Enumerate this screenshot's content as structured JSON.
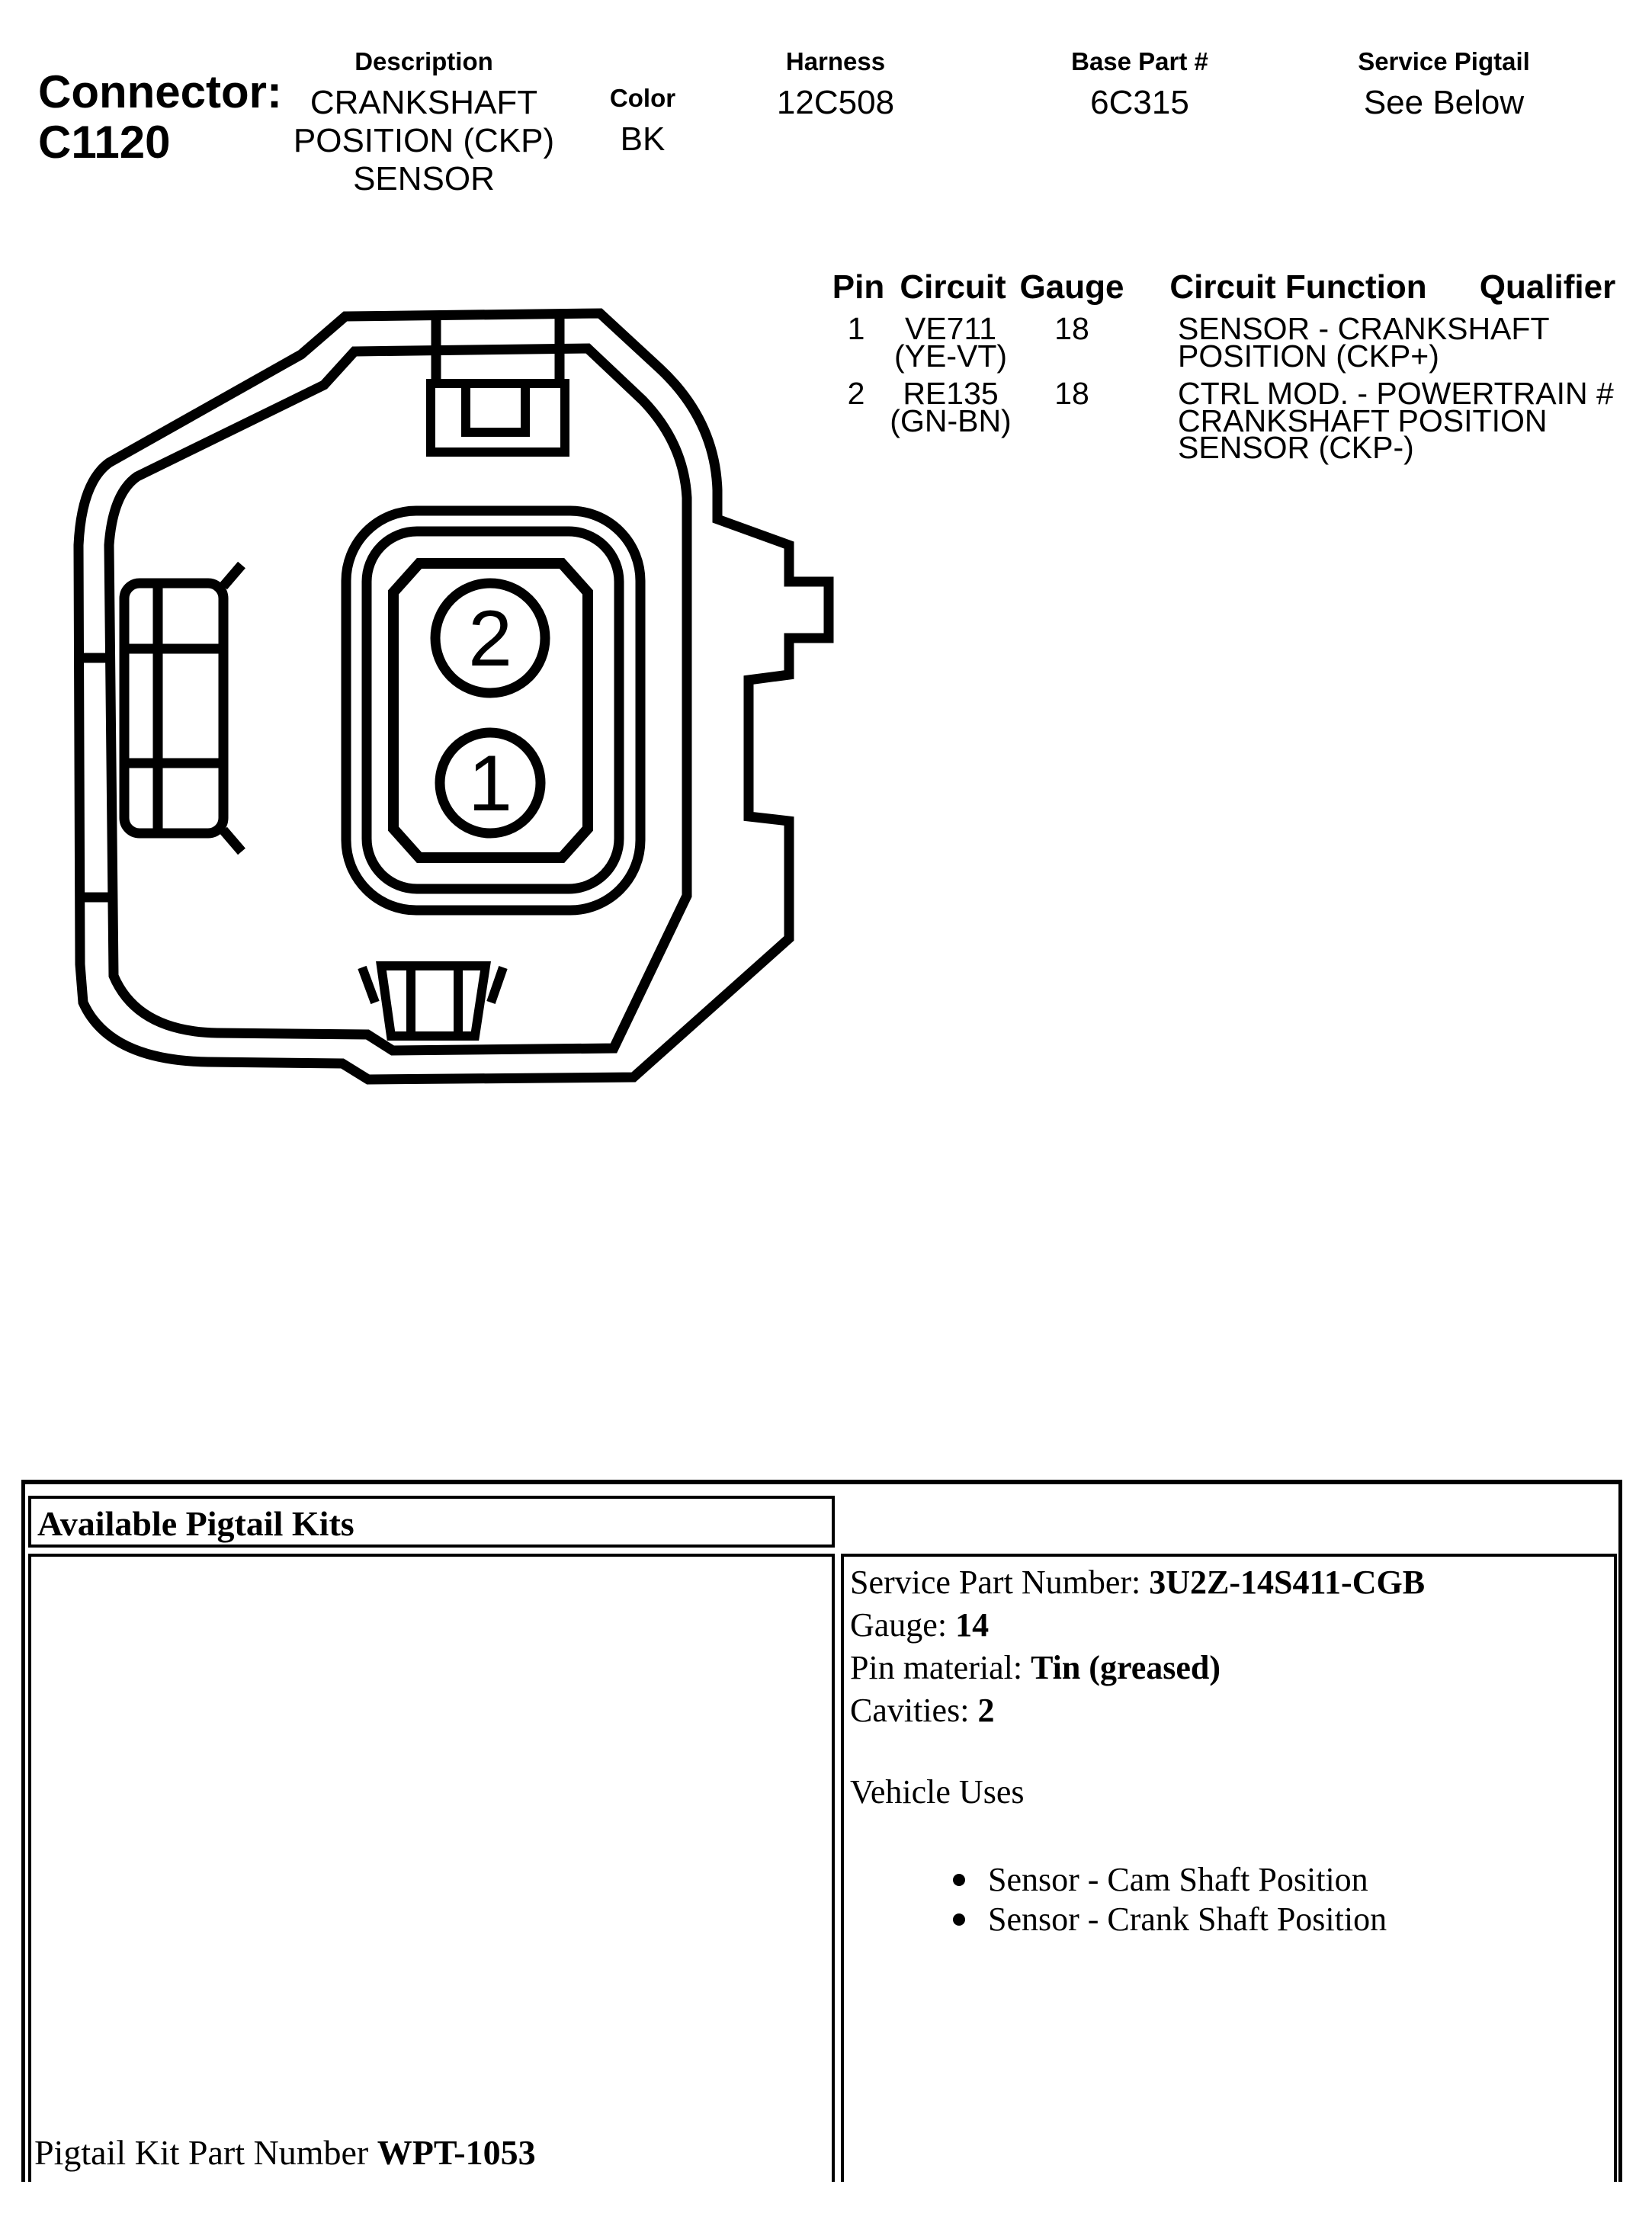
{
  "header": {
    "connector_label": "Connector:",
    "connector_id": "C1120",
    "description_label": "Description",
    "description_value": "CRANKSHAFT POSITION (CKP) SENSOR",
    "color_label": "Color",
    "color_value": "BK",
    "harness_label": "Harness",
    "harness_value": "12C508",
    "base_part_label": "Base Part #",
    "base_part_value": "6C315",
    "service_pigtail_label": "Service Pigtail",
    "service_pigtail_value": "See Below"
  },
  "pin_table": {
    "headers": {
      "pin": "Pin",
      "circuit": "Circuit",
      "gauge": "Gauge",
      "function": "Circuit Function",
      "qualifier": "Qualifier"
    },
    "rows": [
      {
        "pin": "1",
        "circuit": "VE711",
        "circuit_color": "(YE-VT)",
        "gauge": "18",
        "function_lines": [
          "SENSOR - CRANKSHAFT",
          "POSITION (CKP+)"
        ],
        "qualifier": ""
      },
      {
        "pin": "2",
        "circuit": "RE135",
        "circuit_color": "(GN-BN)",
        "gauge": "18",
        "function_lines": [
          "CTRL MOD. - POWERTRAIN #",
          "CRANKSHAFT POSITION",
          "SENSOR (CKP-)"
        ],
        "qualifier": ""
      }
    ]
  },
  "diagram": {
    "pin2_label": "2",
    "pin1_label": "1"
  },
  "pigtail": {
    "section_title": "Available Pigtail Kits",
    "kit_label": "Pigtail Kit Part Number ",
    "kit_number": "WPT-1053",
    "details": [
      {
        "label": "Service Part Number: ",
        "value": "3U2Z-14S411-CGB"
      },
      {
        "label": "Gauge: ",
        "value": "14"
      },
      {
        "label": "Pin material: ",
        "value": "Tin (greased)"
      },
      {
        "label": "Cavities: ",
        "value": "2"
      }
    ],
    "vehicle_uses_title": "Vehicle Uses",
    "vehicle_uses": [
      "Sensor - Cam Shaft Position",
      "Sensor - Crank Shaft Position"
    ]
  },
  "colors": {
    "ink": "#000000",
    "paper": "#ffffff"
  }
}
